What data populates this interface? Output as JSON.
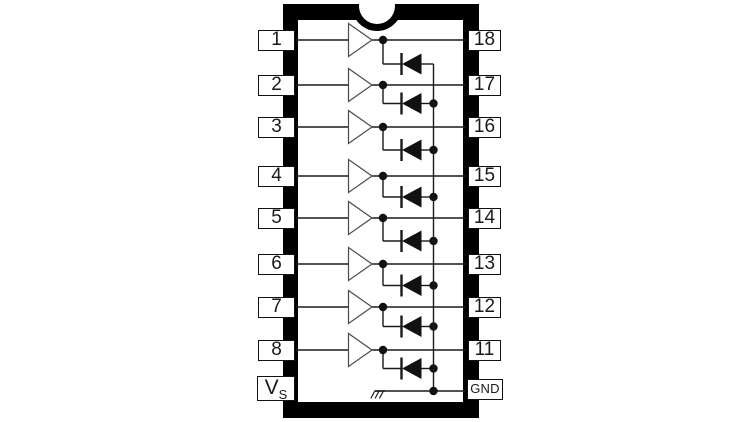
{
  "diagram": {
    "kind": "ic-package-pinout-schematic",
    "package": "18-pin DIP with top index notch",
    "left_pins": [
      {
        "label": "1"
      },
      {
        "label": "2"
      },
      {
        "label": "3"
      },
      {
        "label": "4"
      },
      {
        "label": "5"
      },
      {
        "label": "6"
      },
      {
        "label": "7"
      },
      {
        "label": "8"
      }
    ],
    "supply_pin": {
      "main": "V",
      "sub": "S"
    },
    "right_pins": [
      {
        "label": "18"
      },
      {
        "label": "17"
      },
      {
        "label": "16"
      },
      {
        "label": "15"
      },
      {
        "label": "14"
      },
      {
        "label": "13"
      },
      {
        "label": "12"
      },
      {
        "label": "11"
      }
    ],
    "ground_pin": {
      "label": "GND"
    },
    "channels": [
      {
        "input_pin": "1",
        "output_pin": "18"
      },
      {
        "input_pin": "2",
        "output_pin": "17"
      },
      {
        "input_pin": "3",
        "output_pin": "16"
      },
      {
        "input_pin": "4",
        "output_pin": "15"
      },
      {
        "input_pin": "5",
        "output_pin": "14"
      },
      {
        "input_pin": "6",
        "output_pin": "13"
      },
      {
        "input_pin": "7",
        "output_pin": "12"
      },
      {
        "input_pin": "8",
        "output_pin": "11"
      }
    ],
    "symbols": {
      "buffer": "buffer-icon",
      "diode": "diode-icon",
      "ground": "ground-icon",
      "notch": "index-notch"
    },
    "colors": {
      "package": "#000000",
      "background": "#ffffff",
      "line": "#1a1a1a",
      "buffer_outline": "#4a4a4a",
      "diode_fill": "#111111"
    }
  }
}
